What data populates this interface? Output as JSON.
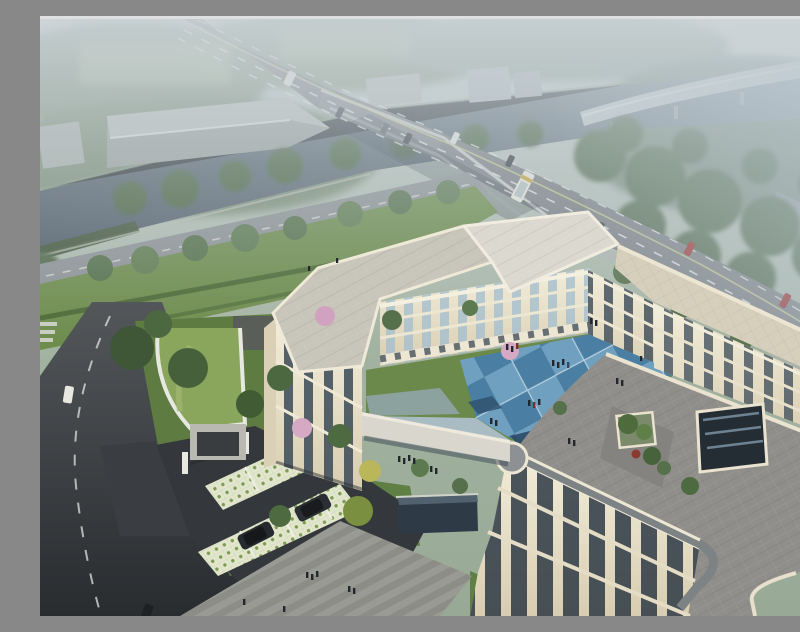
{
  "scene": {
    "label": "Aerial architectural rendering of a three-storey U-shaped civic building beside a river and highway bridge",
    "type": "architectural-aerial-rendering",
    "atmosphere": "hazy daylight, misty horizon",
    "elements": {
      "river": {
        "label": "canal running diagonally upper-left to upper-right",
        "color": "#55616c"
      },
      "bridge_road": {
        "label": "arterial road crossing river on concrete bridge",
        "color": "#7a7e82",
        "vehicles": [
          "white minibus",
          "dark sedans",
          "white car",
          "white coach bus",
          "two red cars"
        ]
      },
      "viaduct": {
        "label": "distant elevated highway curving across top right",
        "color": "#c3cbcd"
      },
      "warehouses": {
        "label": "grey industrial sheds on far river bank",
        "color": "#9aa09c"
      },
      "main_building": {
        "label": "cream stone building, 3 floors, rounded corners, flat roofs",
        "wall_color": "#ece6d2",
        "roof_light": "#c8c5ba",
        "roof_dark": "#8f8e8a",
        "roof_beige": "#d5cfbc",
        "window_color": "#3a4956"
      },
      "courtyard": {
        "label": "checkerboard plaza of blue tiles with people",
        "tile_light": "#6fa0bf",
        "tile_dark": "#4b7ea3",
        "tile_navy": "#2a4a66"
      },
      "roof_terrace": {
        "label": "planted terrace on east roof",
        "planter_green": "#4e6b3e"
      },
      "atrium": {
        "label": "square glazed atrium opening in east roof",
        "color": "#252d34"
      },
      "walkway": {
        "label": "covered link canopy from west wing to front wing",
        "color": "#d8d6cd"
      },
      "gatehouse": {
        "label": "curved entrance pavilion with green roof",
        "roof_color": "#8aa65c"
      },
      "parking": {
        "label": "grass-grid paver stalls with two dark SUVs",
        "paver_color": "#e2e6cd"
      },
      "pool": {
        "label": "dark reflecting pool at building front",
        "color": "#2e3a45"
      },
      "south_plaza": {
        "label": "grey striped pedestrian plaza with people",
        "color": "#979791"
      },
      "street": {
        "label": "city street along left edge with white van",
        "color": "#3c4043"
      },
      "landscape": {
        "label": "lawns, hedges, green / yellow trees, pink blossom trees",
        "lawn": "#6b8a4b",
        "blossom": "#d5a8c4"
      }
    },
    "people_group_count": 12,
    "vehicle_count": 14
  }
}
